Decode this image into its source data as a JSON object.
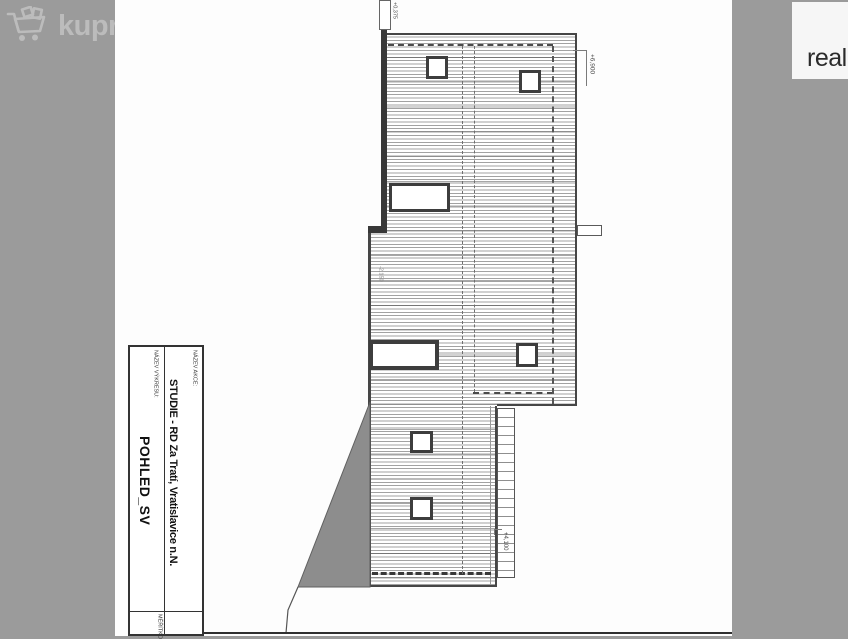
{
  "watermark": {
    "brand": "kupre",
    "icon": "shopping-cart-icon"
  },
  "brand_box": {
    "text": "reali"
  },
  "drawing": {
    "view_name": "POHLED_SV",
    "levels": {
      "parapet": "+0,375",
      "roof": "+6,900",
      "floor": "-2,150",
      "annex": "+4,100"
    },
    "title_block": {
      "project_label": "NÁZEV AKCE:",
      "project_value": "STUDIE - RD Za Tratí, Vratislavice n.N.",
      "view_label": "NÁZEV VÝKRESU:",
      "view_value": "POHLED_SV",
      "scale_label": "MĚŘÍTKO"
    }
  },
  "colors": {
    "background": "#9b9b9b",
    "sheet": "#fdfdfd",
    "ink": "#3c3c3c",
    "terrain_fill": "#8d8d8d",
    "watermark": "#bcbcbc"
  }
}
